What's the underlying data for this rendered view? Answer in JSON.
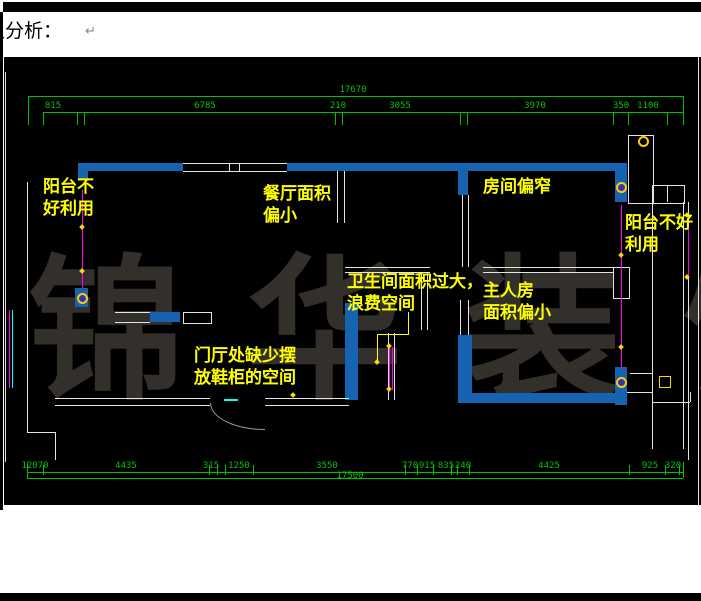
{
  "header": {
    "text_clipped": "型分析：",
    "visible_text": "分析：",
    "paragraph_mark": "↵"
  },
  "drawing": {
    "watermark": "锦 华 装 饰",
    "annotations": [
      {
        "name": "balcony-left",
        "lines": [
          "阳台不",
          "好利用"
        ]
      },
      {
        "name": "dining-area",
        "lines": [
          "餐厅面积",
          "偏小"
        ]
      },
      {
        "name": "narrow-room",
        "lines": [
          "房间偏窄"
        ]
      },
      {
        "name": "balcony-right",
        "lines": [
          "阳台不好",
          "利用"
        ]
      },
      {
        "name": "bathroom",
        "lines": [
          "卫生间面积过大，",
          "浪费空间"
        ]
      },
      {
        "name": "master-bedroom",
        "lines": [
          "主人房",
          "面积偏小"
        ]
      },
      {
        "name": "foyer",
        "lines": [
          "门厅处缺少摆",
          "放鞋柜的空间"
        ]
      }
    ],
    "dims_top": {
      "overall": "17670",
      "chain": [
        "815",
        "6785",
        "210",
        "3055",
        "3970",
        "350",
        "1100"
      ]
    },
    "dims_bottom": {
      "overall": "17500",
      "chain": [
        "12070",
        "4435",
        "315",
        "1250",
        "3550",
        "770",
        "915",
        "835",
        "240",
        "4425",
        "925",
        "320"
      ]
    },
    "colors": {
      "wall_blue": "#1663b2",
      "dimension_green": "#00c400",
      "annotation_yellow": "#ffff00",
      "leader_magenta": "#ff00ff",
      "window_cyan": "#00ffff",
      "watermark_gray": "#332f2b",
      "background": "#000000"
    }
  }
}
